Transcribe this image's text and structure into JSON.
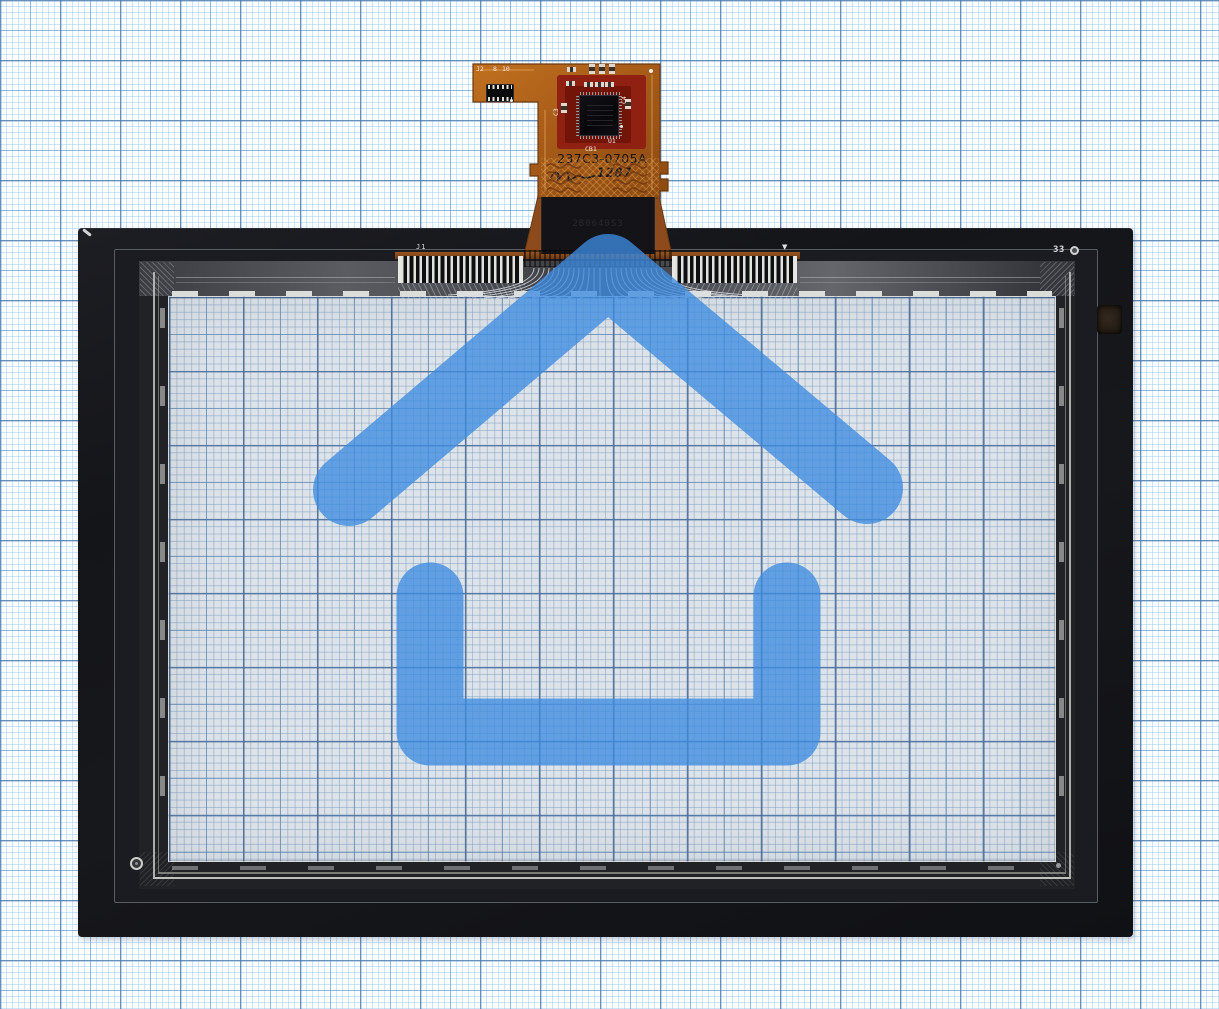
{
  "scene": {
    "description": "touchscreen digitizer panel on millimeter graph paper with watermark",
    "watermark": "house-logo"
  },
  "fpc": {
    "part_number": "237C3-0705A",
    "date_code": "1207",
    "labels": {
      "connector": "J2",
      "pin_first": "8",
      "pin_last": "10",
      "cap_left": "C3",
      "cap_right": "C4",
      "ic": "U1",
      "cap_bottom": "CB1"
    }
  },
  "panel": {
    "connector_label": "J1",
    "alignment_triangle": "▼",
    "corner_mark": "33",
    "stiffener_serial": "2B0640S3"
  },
  "colors": {
    "grid-fine": "rgba(150,200,240,0.45)",
    "grid-medium": "rgba(96,150,205,0.55)",
    "grid-heavy": "rgba(72,118,168,0.60)",
    "grid-fine-in": "rgba(128,168,208,0.50)",
    "grid-medium-in": "rgba(86,134,186,0.60)",
    "grid-heavy-in": "rgba(64,104,156,0.65)",
    "sensor-col": "rgba(90,115,150,0.28)",
    "house-blue": "rgba(61,140,224,0.78)",
    "copper": "#b2661e",
    "copper-dark": "#7a3f10",
    "mask-red": "#8f2012",
    "mask-red-dark": "#721508",
    "frame-black": "#15161a"
  }
}
